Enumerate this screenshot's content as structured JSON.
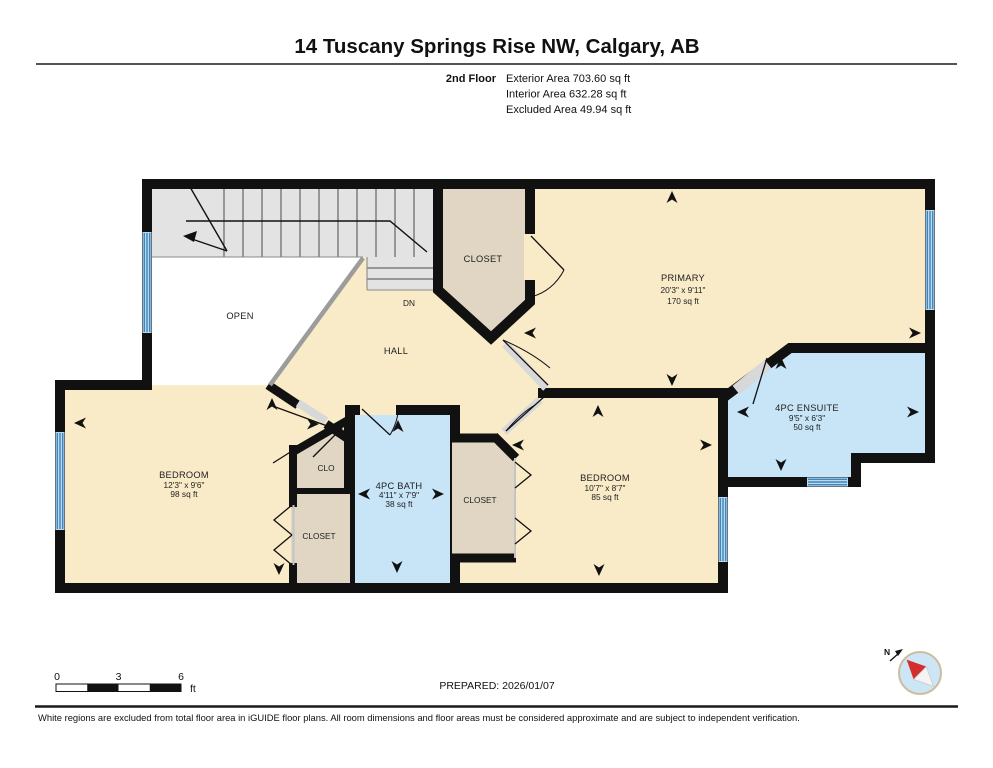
{
  "header": {
    "title": "14 Tuscany Springs Rise NW, Calgary, AB",
    "floor_label": "2nd Floor",
    "areas": [
      "Exterior Area 703.60 sq ft",
      "Interior Area 632.28 sq ft",
      "Excluded Area 49.94 sq ft"
    ]
  },
  "rooms": {
    "primary": {
      "name": "PRIMARY",
      "dims": "20'3\" x 9'11\"",
      "area": "170 sq ft"
    },
    "ensuite": {
      "name": "4PC ENSUITE",
      "dims": "9'5\" x 6'3\"",
      "area": "50 sq ft"
    },
    "bath": {
      "name": "4PC BATH",
      "dims": "4'11\" x 7'9\"",
      "area": "38 sq ft"
    },
    "bedroom_left": {
      "name": "BEDROOM",
      "dims": "12'3\" x 9'6\"",
      "area": "98 sq ft"
    },
    "bedroom_right": {
      "name": "BEDROOM",
      "dims": "10'7\" x 8'7\"",
      "area": "85 sq ft"
    },
    "closet_top": {
      "name": "CLOSET"
    },
    "clo": {
      "name": "CLO"
    },
    "closet_left": {
      "name": "CLOSET"
    },
    "closet_right": {
      "name": "CLOSET"
    },
    "hall": {
      "name": "HALL"
    },
    "open": {
      "name": "OPEN"
    },
    "dn": {
      "label": "DN"
    }
  },
  "scalebar": {
    "t0": "0",
    "t3": "3",
    "t6": "6",
    "unit": "ft"
  },
  "compass": {
    "n": "N"
  },
  "footer": {
    "prepared": "PREPARED: 2026/01/07",
    "disclaimer": "White regions are excluded from total floor area in iGUIDE floor plans. All room dimensions and floor areas must be considered approximate and are subject to independent verification."
  },
  "colors": {
    "wall": "#111111",
    "room_cream": "#F9EBC7",
    "bath_blue": "#C8E4F7",
    "closet_tan": "#E0D6C3",
    "stair_grey": "#E3E3E3",
    "window_blue_light": "#BCD9EE",
    "window_blue_dark": "#3C85BD",
    "compass_red": "#D42F2F",
    "compass_face": "#CDE6F5",
    "compass_ring": "#CBBD9E"
  }
}
